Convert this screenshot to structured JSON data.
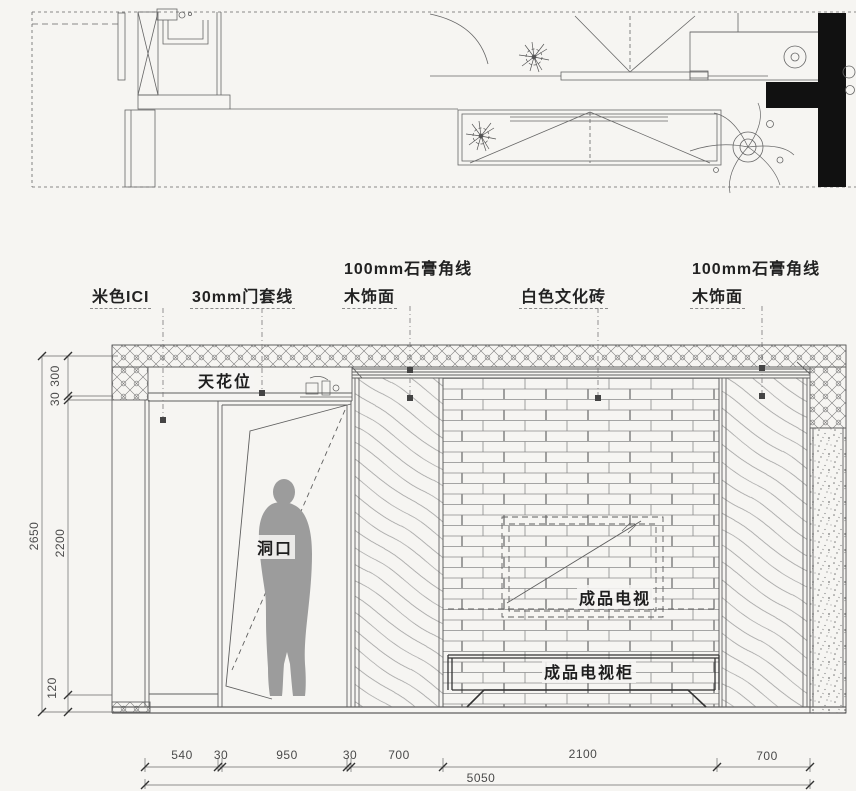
{
  "drawing": {
    "sheet_type": "interior CAD drawing - TV background wall elevation with plan strip",
    "annotations": {
      "beige_ici": "米色ICI",
      "door_casing": "30mm门套线",
      "plaster_corner_left_line1": "100mm石膏角线",
      "plaster_corner_left_line2": "木饰面",
      "white_culture_brick": "白色文化砖",
      "plaster_corner_right_line1": "100mm石膏角线",
      "plaster_corner_right_line2": "木饰面",
      "ceiling_position": "天花位",
      "door_opening": "洞口",
      "tv": "成品电视",
      "tv_cabinet": "成品电视柜"
    },
    "dimensions_mm": {
      "horizontal_chain": [
        "540",
        "30",
        "950",
        "30",
        "700",
        "2100",
        "700"
      ],
      "horizontal_total": "5050",
      "vertical_chain_top_to_bottom": [
        "300",
        "30",
        "2200",
        "120"
      ],
      "vertical_total": "2650"
    },
    "colors": {
      "background": "#f6f5f2",
      "line": "#5f5f5f",
      "dark_fill": "#111111",
      "silhouette": "#9c9c9c",
      "text": "#222222"
    }
  }
}
